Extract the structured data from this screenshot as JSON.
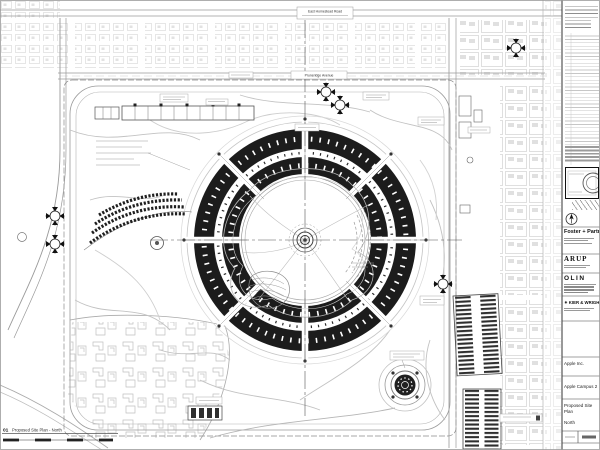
{
  "sheet": {
    "drawing_number": "01",
    "drawing_title": "Proposed Site Plan - North",
    "roads": {
      "homestead": "East Homestead Road",
      "pruneridge": "Pruneridge Avenue"
    },
    "title_block": {
      "architect": "Foster + Partners",
      "consultants": [
        "ARUP",
        "OLIN",
        "KIER & WRIGHT"
      ],
      "client": "Apple Inc.",
      "project": "Apple Campus 2",
      "sheet_name_lines": [
        "Proposed Site",
        "Plan",
        "North"
      ]
    },
    "colors": {
      "ink": "#1c1c1c",
      "line": "#999999",
      "faint": "#cccccc",
      "paper": "#ffffff"
    }
  }
}
